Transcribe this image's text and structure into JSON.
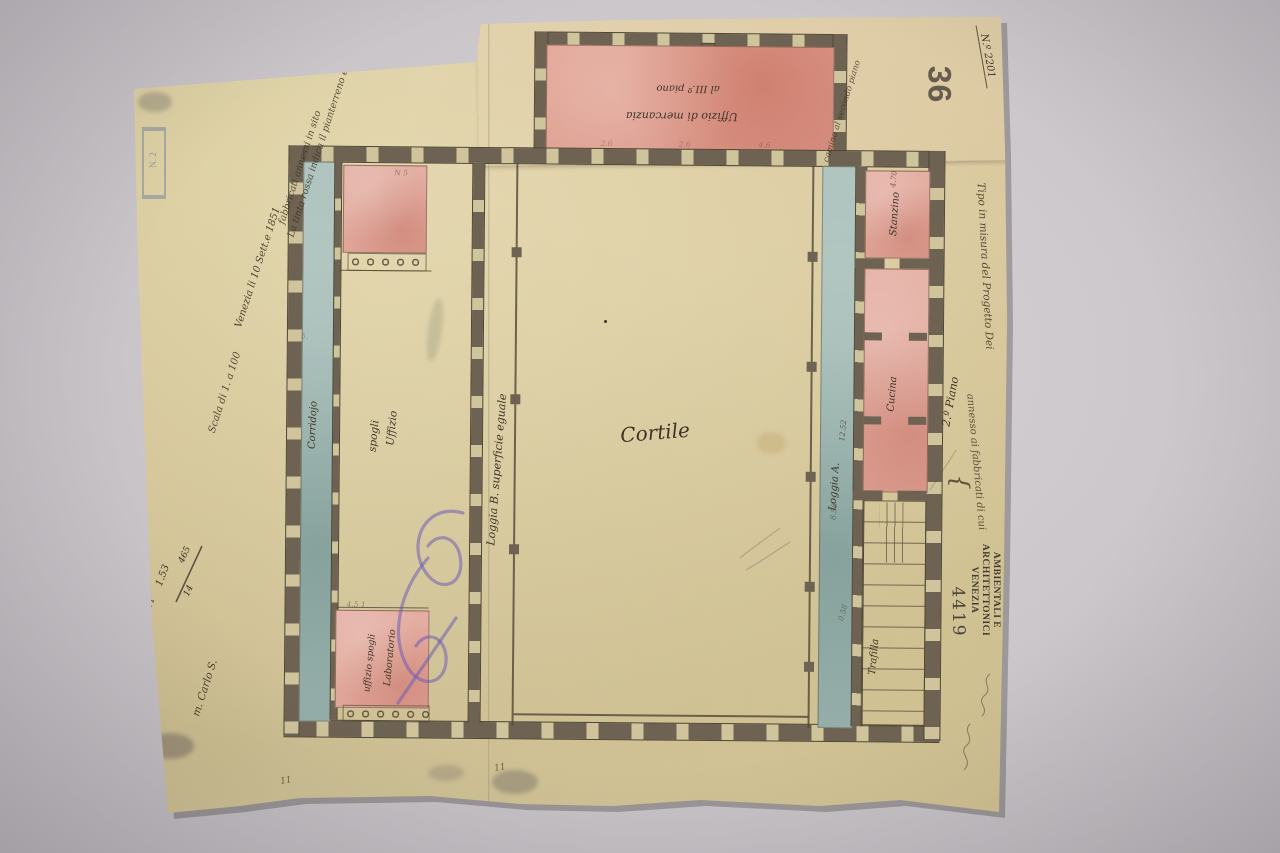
{
  "photo": {
    "paper_hex": "#d7ca9e",
    "wall_hex": "#6e6352",
    "pink_wash_hex": "#e0a394",
    "blue_wash_hex": "#a3bab5",
    "ink_hex": "#3e3425",
    "scribble_hex": "#705cb4"
  },
  "header_stamps": {
    "big_number": "36",
    "soprintendenza_lines": [
      "SOPRINTENDENZA PER I BENI",
      "AMBIENTALI E ARCHITETTONICI",
      "VENEZIA"
    ],
    "inventory_number": "4419",
    "blue_stamp_number": "N. 2",
    "doc_number": "N.º 2201"
  },
  "plan": {
    "cortile": "Cortile",
    "corridojo": "Corridojo",
    "loggia_b_note": "Loggia B. superficie eguale",
    "loggia_a": "Loggia A.",
    "stanzino": "Stanzino",
    "cucina": "Cucina",
    "stair": "Trafilla",
    "office_line1": "Uffizio",
    "office_line2": "spogli",
    "lab_line1": "Laboratorio",
    "lab_line2": "uffizio spogli",
    "annex_name": "Uffizio di mercanzia",
    "annex_floor": "al III.º piano",
    "annex_side_note": "camino al secondo piano",
    "wing_floor_note": "2.º Piano"
  },
  "margin": {
    "note_line1": "La tinta rossa indica il pianterreno ed i",
    "note_line2": "fabbricati annessi in sito",
    "date_line": "Venezia li 10 Sett.e 1851",
    "scale_line": "Scala di 1. a 100",
    "frac_top": "465",
    "frac_bottom": "14",
    "frac_side": "1.53",
    "frac_tick": "11",
    "signature": "m. Carlo S.",
    "annotation_line1": "Tipo in misura del Progetto Dei",
    "annotation_line2": "annesso ai fabbricati di cui",
    "brace": "{",
    "tick_a": "11",
    "tick_b": "11"
  },
  "measurements": [
    {
      "t": "N 5",
      "x": 392,
      "y": 170,
      "r": 0,
      "o": 0.5
    },
    {
      "t": "5.",
      "x": 300,
      "y": 334,
      "r": 0,
      "o": 0.45
    },
    {
      "t": "4.5 1",
      "x": 348,
      "y": 602,
      "r": 0,
      "o": 0.5
    },
    {
      "t": "2.6",
      "x": 598,
      "y": 139,
      "r": 0,
      "o": 0.4
    },
    {
      "t": "2.6",
      "x": 676,
      "y": 139,
      "r": 0,
      "o": 0.4
    },
    {
      "t": "4.6",
      "x": 756,
      "y": 139,
      "r": 0,
      "o": 0.4
    },
    {
      "t": "4.70",
      "x": 883,
      "y": 172,
      "r": -85,
      "o": 0.7
    },
    {
      "t": "12.52",
      "x": 832,
      "y": 424,
      "r": -85,
      "o": 0.75
    },
    {
      "t": "8.58",
      "x": 826,
      "y": 505,
      "r": -85,
      "o": 0.6
    },
    {
      "t": "0.58",
      "x": 836,
      "y": 606,
      "r": -75,
      "o": 0.55
    }
  ]
}
